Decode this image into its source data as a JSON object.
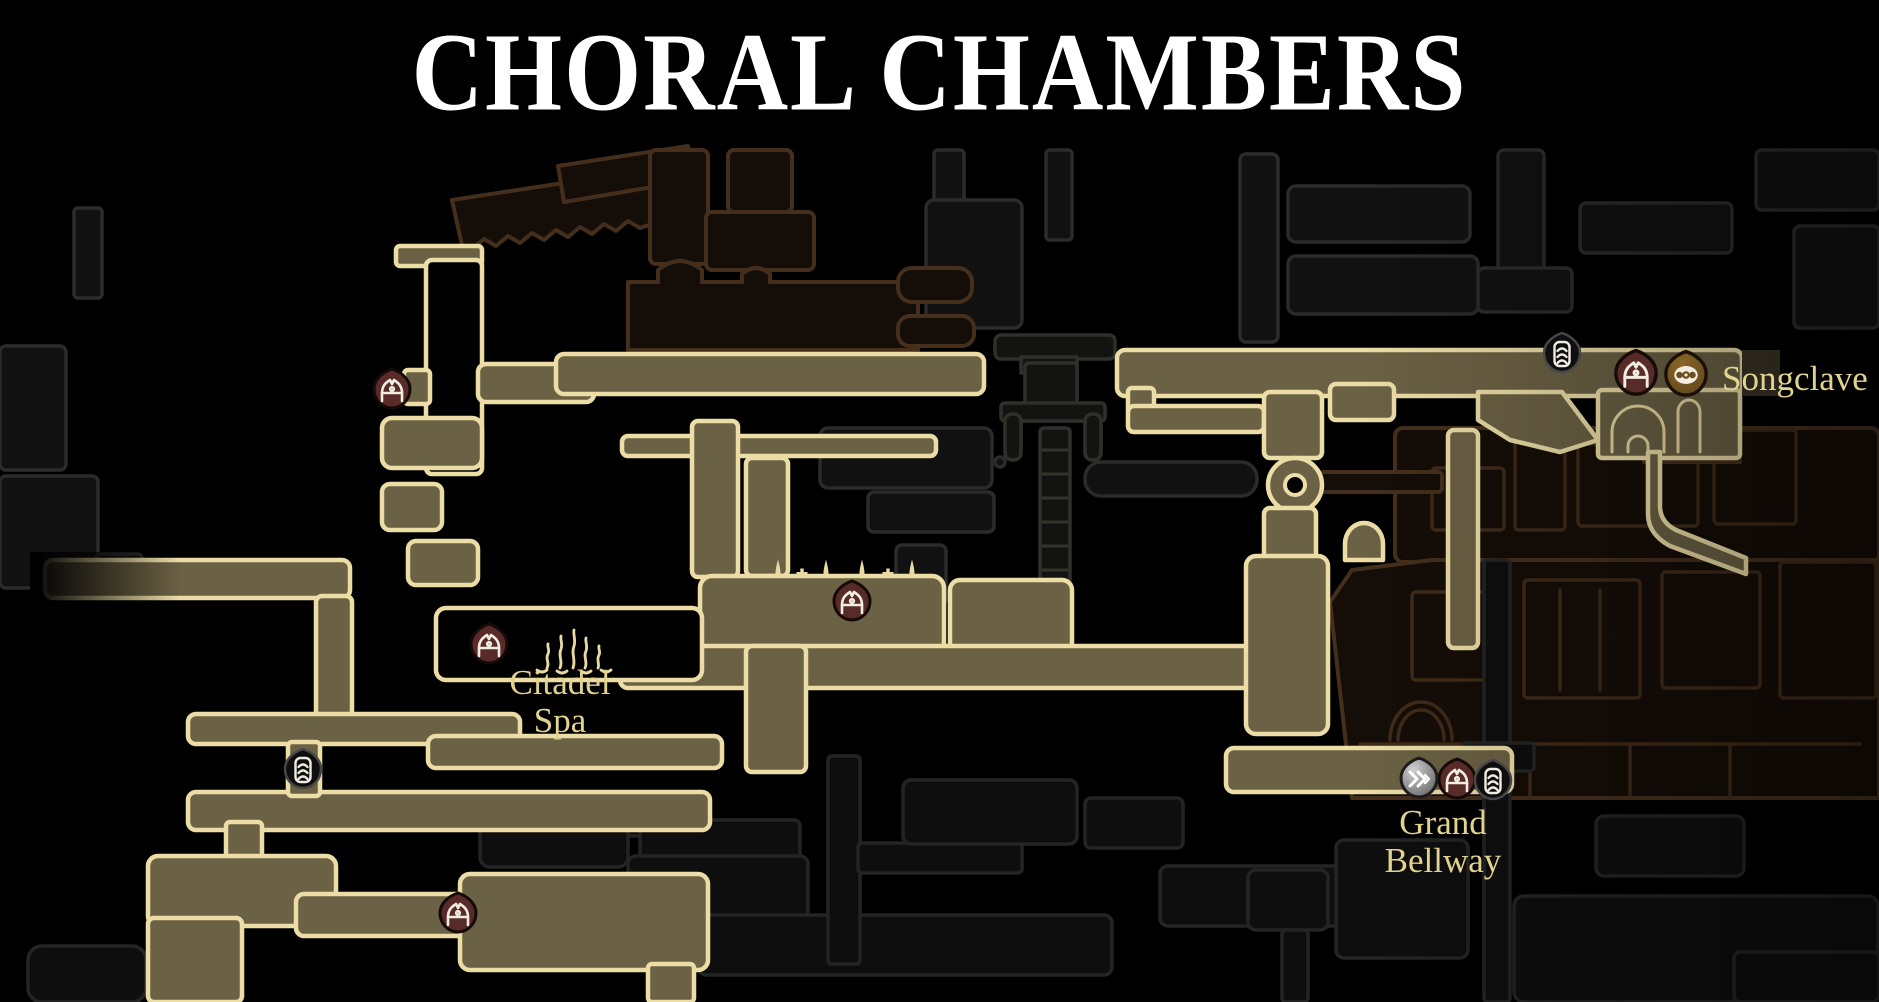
{
  "title": "CHORAL CHAMBERS",
  "map": {
    "region_name": "Choral Chambers",
    "labels": [
      {
        "text": "Songclave",
        "x": 1722,
        "y": 390,
        "anchor": "start",
        "size": 35,
        "color": "#ece0b4"
      },
      {
        "text": "Citadel",
        "x": 560,
        "y": 694,
        "anchor": "middle",
        "size": 35,
        "color": "#e2d28f"
      },
      {
        "text": "Spa",
        "x": 560,
        "y": 732,
        "anchor": "middle",
        "size": 35,
        "color": "#e2d28f"
      },
      {
        "text": "Grand",
        "x": 1443,
        "y": 834,
        "anchor": "middle",
        "size": 35,
        "color": "#e2d28f"
      },
      {
        "text": "Bellway",
        "x": 1443,
        "y": 872,
        "anchor": "middle",
        "size": 35,
        "color": "#e2d28f"
      }
    ],
    "markers": [
      {
        "type": "bench",
        "x": 392,
        "y": 390,
        "s": 1
      },
      {
        "type": "bench",
        "x": 852,
        "y": 602,
        "s": 1
      },
      {
        "type": "bench",
        "x": 489,
        "y": 645,
        "s": 1
      },
      {
        "type": "bench",
        "x": 458,
        "y": 914,
        "s": 1
      },
      {
        "type": "bench",
        "x": 1636,
        "y": 374,
        "s": 1.12
      },
      {
        "type": "bench",
        "x": 1457,
        "y": 780,
        "s": 1
      },
      {
        "type": "tube",
        "x": 1562,
        "y": 354,
        "s": 1
      },
      {
        "type": "tube",
        "x": 303,
        "y": 770,
        "s": 1
      },
      {
        "type": "tube",
        "x": 1493,
        "y": 781,
        "s": 1
      },
      {
        "type": "fast-travel",
        "x": 1419,
        "y": 779,
        "s": 1
      },
      {
        "type": "vendor",
        "x": 1686,
        "y": 375,
        "s": 1.12
      }
    ],
    "icon_types": {
      "bench": "bench-icon",
      "tube": "bell-station-icon",
      "fast-travel": "fast-travel-icon",
      "vendor": "songclave-vendor-icon"
    },
    "colors": {
      "background": "#000000",
      "explored_fill": "#6b6144",
      "explored_stroke": "#ecdda6",
      "unexplored_gray_stroke": "#2b2b2b",
      "unexplored_brown_stroke": "#452f1c",
      "bench_marker": "#582b28",
      "vendor_marker": "#7a5a24",
      "fast_travel_marker": "#a8a8a8",
      "label_text": "#e2d28f",
      "title_text": "#ffffff"
    }
  }
}
